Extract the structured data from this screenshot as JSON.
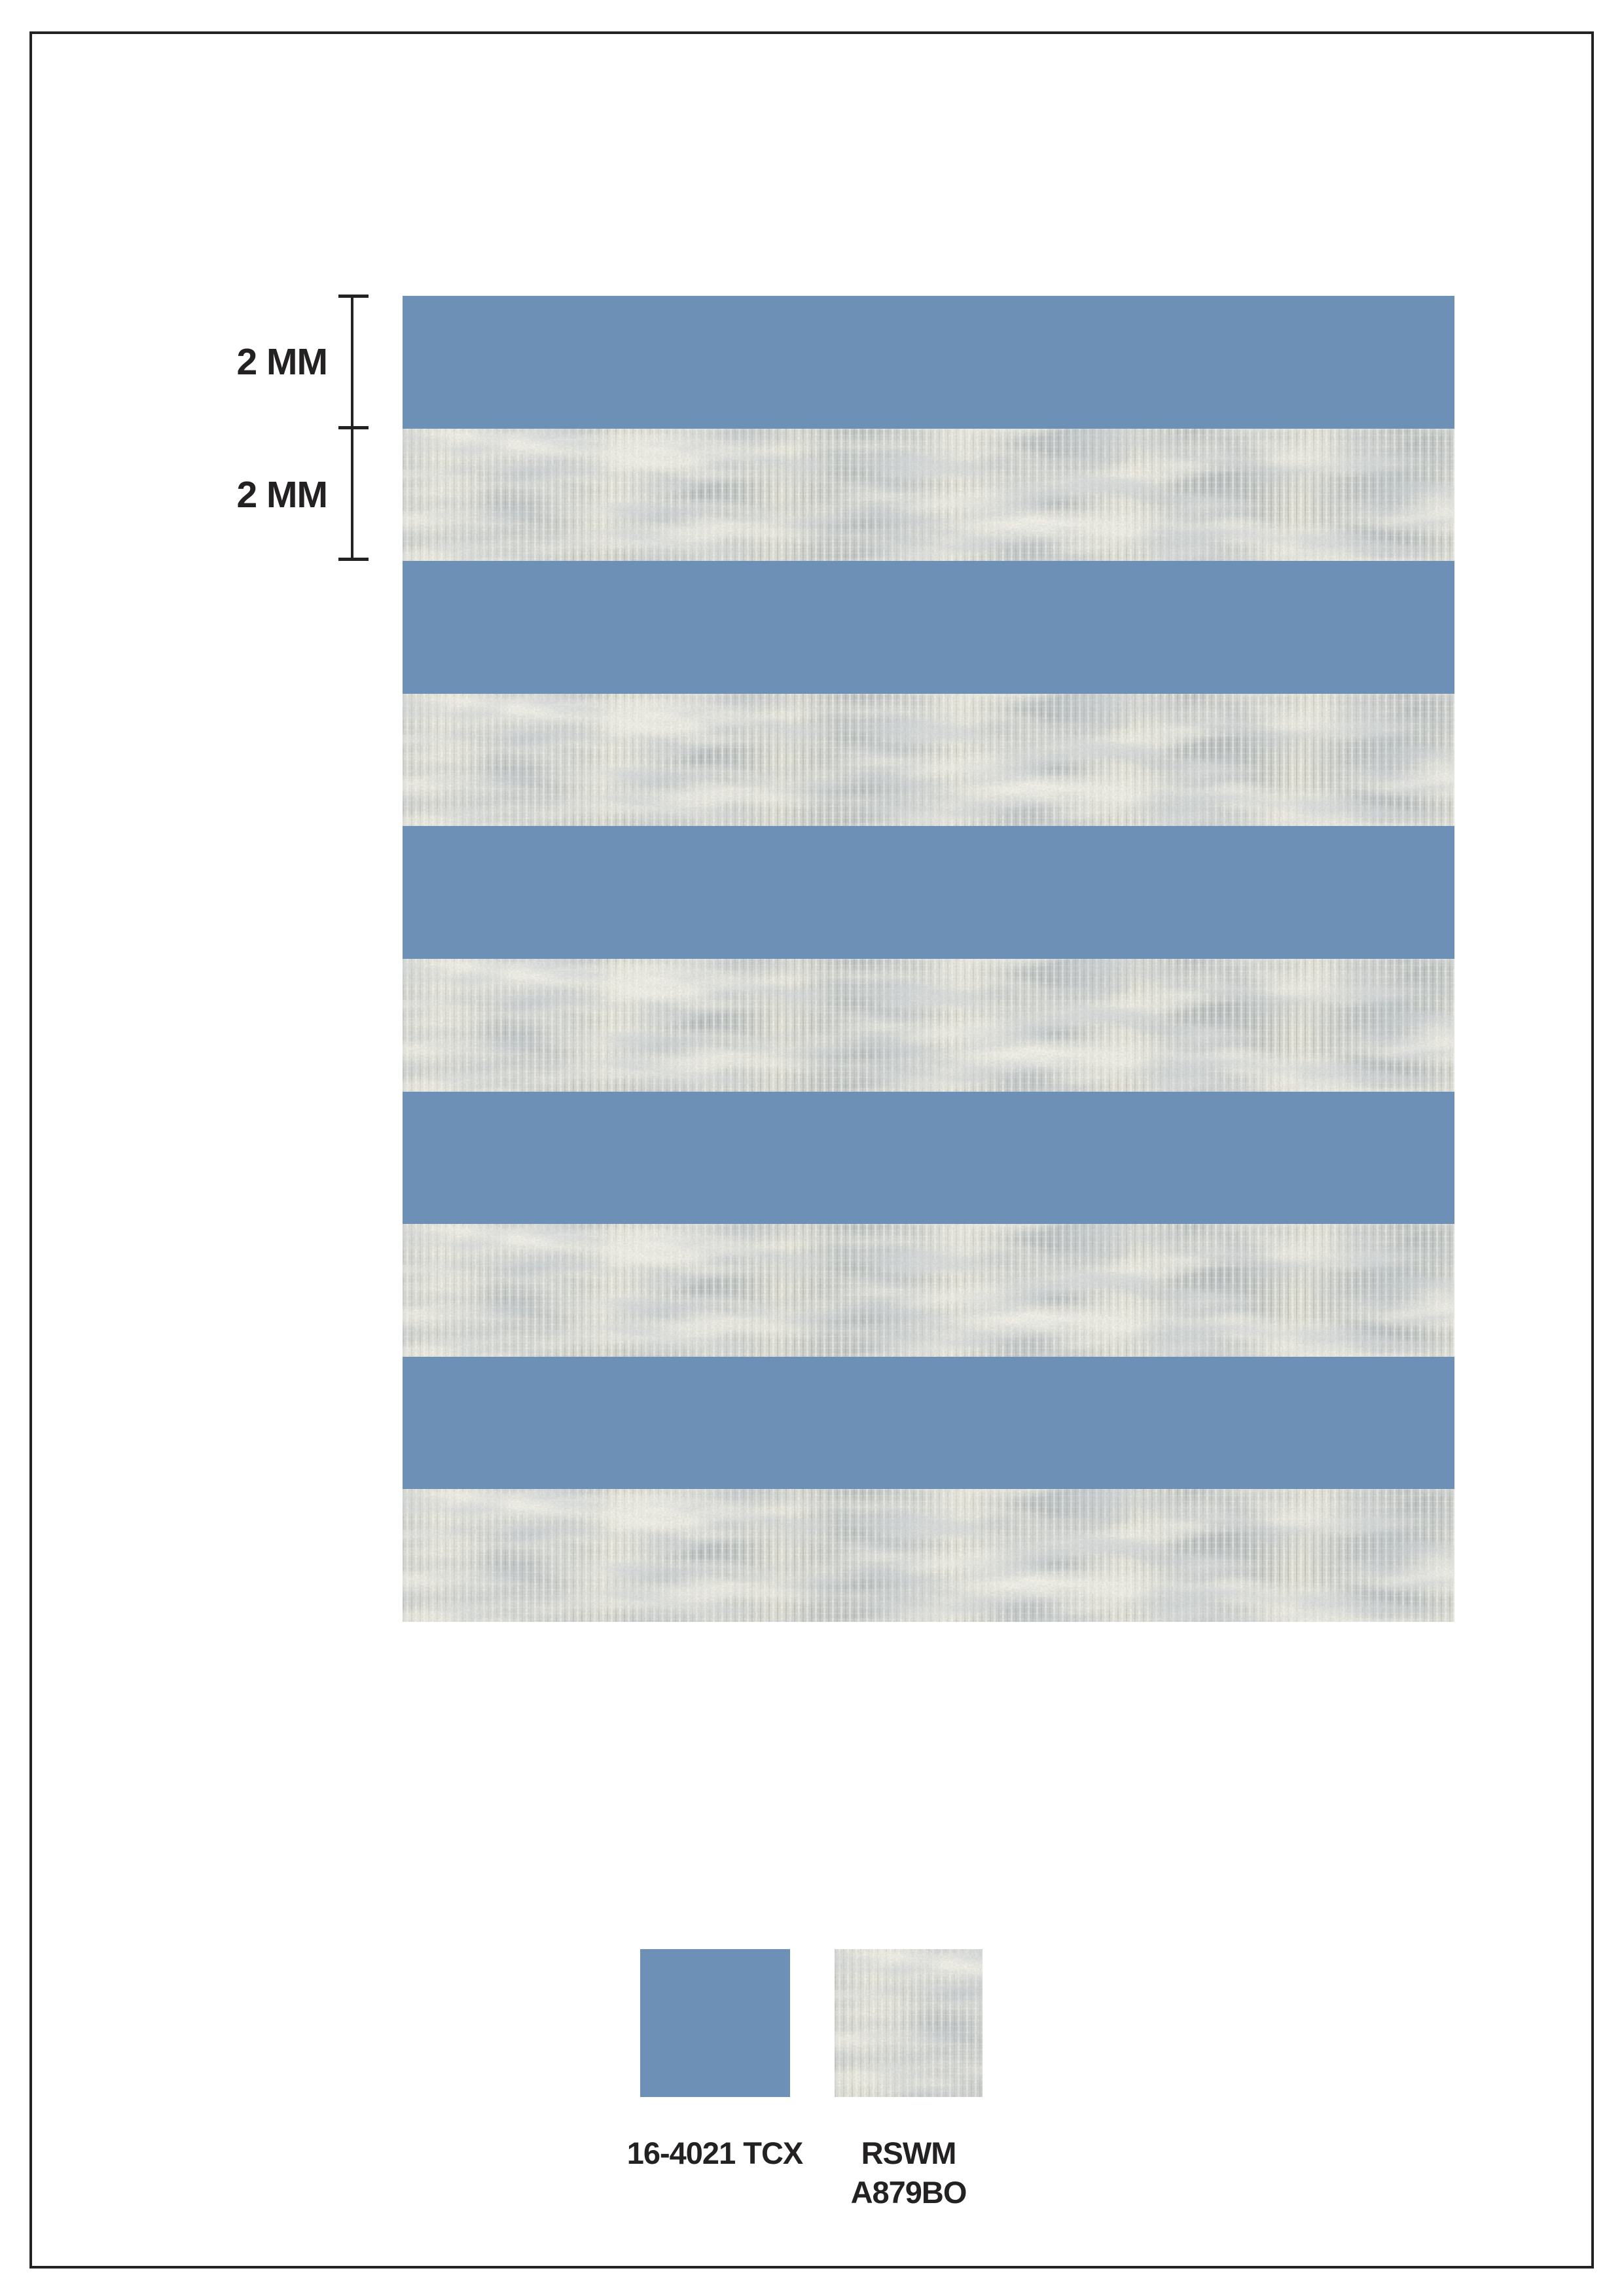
{
  "page": {
    "background": "#FFFFFF",
    "ink_color": "#242122",
    "border_color": "#242122"
  },
  "dimensions": {
    "stripe1_label": "2 MM",
    "stripe2_label": "2 MM"
  },
  "pattern": {
    "repeat": [
      "blue",
      "heather",
      "blue",
      "heather",
      "blue",
      "heather",
      "blue",
      "heather",
      "blue",
      "heather"
    ],
    "blue_hex": "#6D90B6",
    "heather_base_hex": "#C8CCC7",
    "heather_cream_hex": "#F0ECDA",
    "heather_shadow_hex": "#A8B0B5"
  },
  "legend": [
    {
      "swatch": "blue",
      "lines": [
        "16-4021 TCX"
      ]
    },
    {
      "swatch": "heather",
      "lines": [
        "RSWM",
        "A879BO"
      ]
    }
  ]
}
